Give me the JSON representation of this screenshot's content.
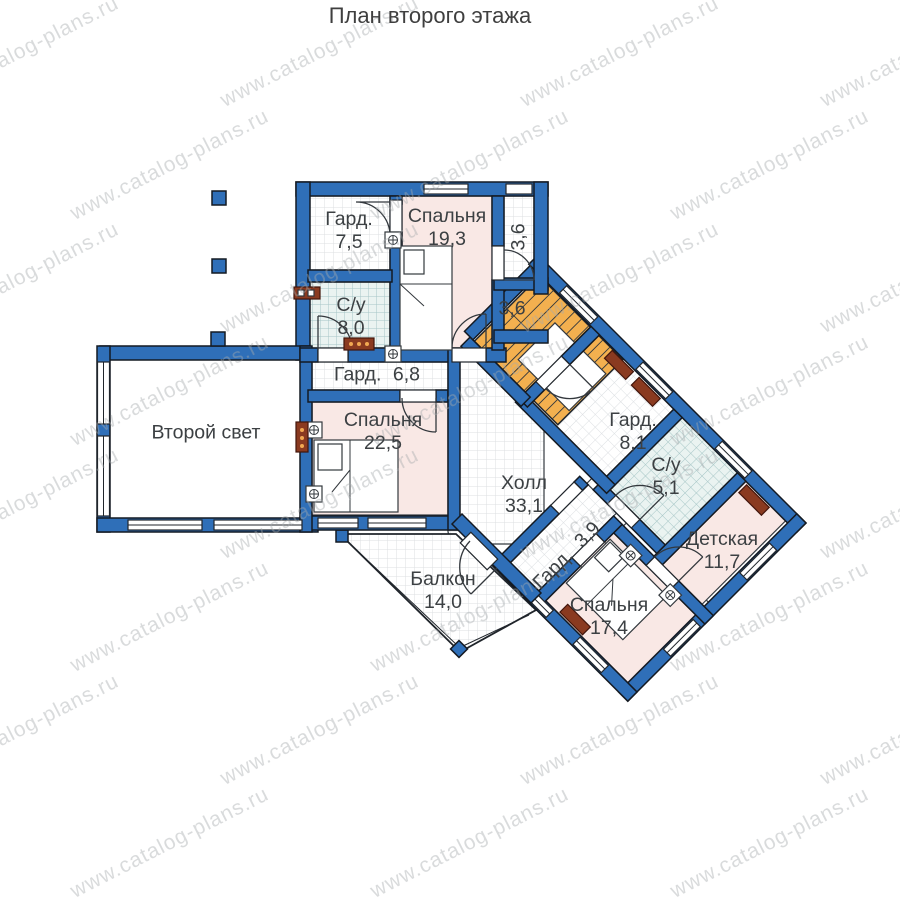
{
  "title": "План второго этажа",
  "watermark": {
    "text": "www.catalog-plans.ru"
  },
  "rooms": {
    "wardrobe_top": {
      "name": "Гард.",
      "area": "7,5"
    },
    "bedroom_19": {
      "name": "Спальня",
      "area": "19,3"
    },
    "balcony_strip": {
      "area": "3,6"
    },
    "bathroom_8": {
      "name": "С/у",
      "area": "8,0"
    },
    "closet_stairs": {
      "area": "3,6"
    },
    "wardrobe_68": {
      "name": "Гард.",
      "area": "6,8"
    },
    "bedroom_22": {
      "name": "Спальня",
      "area": "22,5"
    },
    "second_light": {
      "name": "Второй свет"
    },
    "hall": {
      "name": "Холл",
      "area": "33,1"
    },
    "wardrobe_81": {
      "name": "Гард.",
      "area": "8,1"
    },
    "bathroom_51": {
      "name": "С/у",
      "area": "5,1"
    },
    "kids_room": {
      "name": "Детская",
      "area": "11,7"
    },
    "bedroom_17": {
      "name": "Спальня",
      "area": "17,4"
    },
    "wardrobe_39": {
      "name": "Гард.",
      "area": "3,9"
    },
    "balcony": {
      "name": "Балкон",
      "area": "14,0"
    }
  },
  "colors": {
    "wall": "#2f6fb8",
    "bedroom": "#f9e8e5",
    "bathroom_tile": "#eaf3f1",
    "stairs": "#f3b04f",
    "radiator": "#8a3a20"
  }
}
